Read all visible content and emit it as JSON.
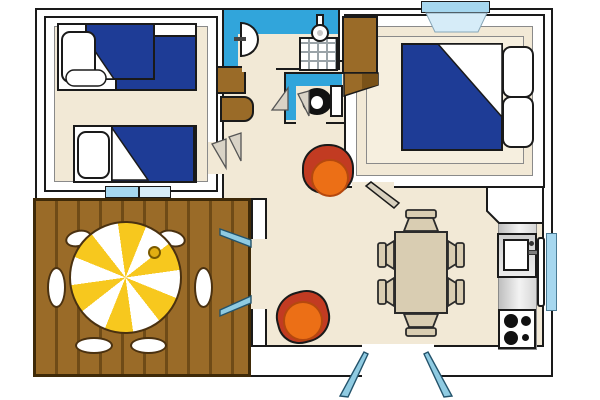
{
  "palette": {
    "wall-line": "#1a1a1a",
    "floor": "#f2e9d6",
    "floor-light": "#f6efdf",
    "blanket-blue": "#1e3c96",
    "bath-blue": "#31a5db",
    "window-blue": "#a6d7ef",
    "window-light": "#d6ecf8",
    "door-blue": "#8fcbe2",
    "wood": "#9a6b28",
    "wood-dark": "#6f4b17",
    "wood-line": "#3f2a08",
    "tan": "#d9cdb2",
    "chair-red": "#c23b22",
    "chair-orange": "#ec6f16",
    "parasol-yellow": "#f7c81e",
    "swing-gray": "#d9d3c6"
  },
  "rooms": [
    {
      "name": "twin-bedroom",
      "furniture": [
        "single-bed",
        "single-bed",
        "hall-cabinets"
      ]
    },
    {
      "name": "bathroom",
      "furniture": [
        "washbasin",
        "shower"
      ]
    },
    {
      "name": "wc",
      "furniture": [
        "toilet"
      ]
    },
    {
      "name": "double-bedroom",
      "furniture": [
        "double-bed",
        "wardrobe"
      ]
    },
    {
      "name": "living-dining",
      "furniture": [
        "dining-table",
        "dining-chair-x6",
        "armchair-x2"
      ]
    },
    {
      "name": "kitchenette",
      "furniture": [
        "counter",
        "sink",
        "hob-4-burners"
      ]
    },
    {
      "name": "terrace",
      "furniture": [
        "round-table",
        "parasol",
        "terrace-chair-x6"
      ]
    }
  ],
  "openings": {
    "front-door": "double-leaf-outward",
    "terrace-door": "double-leaf",
    "windows": [
      "double-bedroom-top",
      "kitchen-right-wall",
      "twin-bedroom-to-terrace"
    ]
  }
}
